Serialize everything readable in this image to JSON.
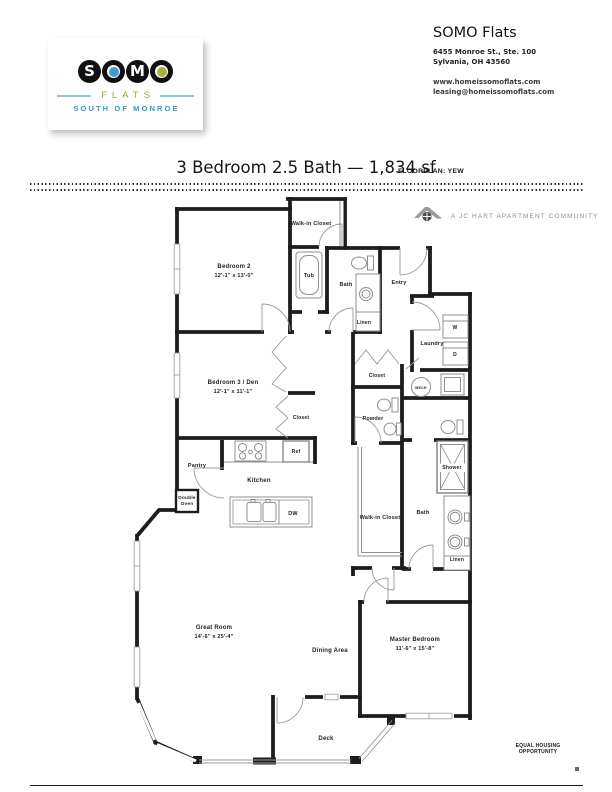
{
  "header": {
    "logo": {
      "letters": [
        "S",
        "O",
        "M",
        "O"
      ],
      "flats": "FLATS",
      "tagline": "SOUTH OF MONROE",
      "colors": {
        "dot_blue": "#3E9EC9",
        "dot_olive": "#A9B23A",
        "flats_olive": "#9AA83E",
        "dash_blue": "#8EC6DE",
        "tagline_teal": "#2E9BC5"
      }
    },
    "contact": {
      "name": "SOMO Flats",
      "address_line1": "6455 Monroe St., Ste. 100",
      "address_line2": "Sylvania, OH 43560",
      "website": "www.homeissomoflats.com",
      "email": "leasing@homeissomoflats.com"
    }
  },
  "title": {
    "main": "3 Bedroom 2.5 Bath — 1,834 sf",
    "floorplan_label": "FLOORPLAN: YEW"
  },
  "branding": {
    "community_line": "A JC HART APARTMENT COMMUNITY"
  },
  "footer": {
    "equal_housing": "EQUAL HOUSING OPPORTUNITY"
  },
  "floorplan": {
    "name": "YEW",
    "beds": 3,
    "baths": 2.5,
    "square_feet": "1,834",
    "labels": [
      {
        "name": "walk-in-closet-2",
        "text": "Walk-in Closet",
        "x": 311,
        "y": 225,
        "size": 5.5
      },
      {
        "name": "bedroom-2",
        "text": "Bedroom 2",
        "x": 234,
        "y": 268,
        "size": 6
      },
      {
        "name": "bedroom-2-dims",
        "text": "12'-1\" x 13'-0\"",
        "x": 234,
        "y": 277,
        "size": 5.5
      },
      {
        "name": "tub",
        "text": "Tub",
        "x": 309,
        "y": 277,
        "size": 5.5
      },
      {
        "name": "bath-main",
        "text": "Bath",
        "x": 346,
        "y": 286,
        "size": 5.5
      },
      {
        "name": "entry",
        "text": "Entry",
        "x": 399,
        "y": 284,
        "size": 5.5
      },
      {
        "name": "linen-main",
        "text": "Linen",
        "x": 364,
        "y": 324,
        "size": 5
      },
      {
        "name": "laundry",
        "text": "Laundry",
        "x": 432,
        "y": 345,
        "size": 5.5
      },
      {
        "name": "washer",
        "text": "W",
        "x": 455,
        "y": 329,
        "size": 5
      },
      {
        "name": "dryer",
        "text": "D",
        "x": 455,
        "y": 356,
        "size": 5
      },
      {
        "name": "closet-hall",
        "text": "Closet",
        "x": 377,
        "y": 377,
        "size": 5
      },
      {
        "name": "mech",
        "text": "MECH",
        "x": 421,
        "y": 389,
        "size": 3.6
      },
      {
        "name": "powder",
        "text": "Powder",
        "x": 373,
        "y": 420,
        "size": 5.5
      },
      {
        "name": "bedroom-3",
        "text": "Bedroom 3 / Den",
        "x": 233,
        "y": 384,
        "size": 6
      },
      {
        "name": "bedroom-3-dims",
        "text": "12'-1\" x 11'-1\"",
        "x": 233,
        "y": 393,
        "size": 5.5
      },
      {
        "name": "closet-bedroom-3",
        "text": "Closet",
        "x": 301,
        "y": 419,
        "size": 5
      },
      {
        "name": "ref",
        "text": "Ref",
        "x": 296,
        "y": 453,
        "size": 5
      },
      {
        "name": "pantry",
        "text": "Pantry",
        "x": 197,
        "y": 467,
        "size": 5.5
      },
      {
        "name": "kitchen",
        "text": "Kitchen",
        "x": 259,
        "y": 482,
        "size": 6
      },
      {
        "name": "double-oven-line1",
        "text": "Double",
        "x": 187,
        "y": 499,
        "size": 4.8
      },
      {
        "name": "double-oven-line2",
        "text": "Oven",
        "x": 187,
        "y": 505,
        "size": 4.8
      },
      {
        "name": "dw",
        "text": "DW",
        "x": 293,
        "y": 515,
        "size": 5.5
      },
      {
        "name": "shower",
        "text": "Shower",
        "x": 452,
        "y": 469,
        "size": 5
      },
      {
        "name": "walk-in-closet-master",
        "text": "Walk-in Closet",
        "x": 380,
        "y": 519,
        "size": 5.5
      },
      {
        "name": "bath-master",
        "text": "Bath",
        "x": 423,
        "y": 514,
        "size": 5.5
      },
      {
        "name": "linen-master",
        "text": "Linen",
        "x": 457,
        "y": 561,
        "size": 5
      },
      {
        "name": "great-room",
        "text": "Great Room",
        "x": 214,
        "y": 629,
        "size": 6
      },
      {
        "name": "great-room-dims",
        "text": "14'-6\" x 25'-4\"",
        "x": 214,
        "y": 638,
        "size": 5.5
      },
      {
        "name": "dining-area",
        "text": "Dining Area",
        "x": 330,
        "y": 652,
        "size": 6
      },
      {
        "name": "master-bedroom",
        "text": "Master Bedroom",
        "x": 415,
        "y": 641,
        "size": 6
      },
      {
        "name": "master-bedroom-dims",
        "text": "11'-6\" x 15'-8\"",
        "x": 415,
        "y": 650,
        "size": 5.5
      },
      {
        "name": "deck",
        "text": "Deck",
        "x": 326,
        "y": 740,
        "size": 6
      }
    ]
  }
}
